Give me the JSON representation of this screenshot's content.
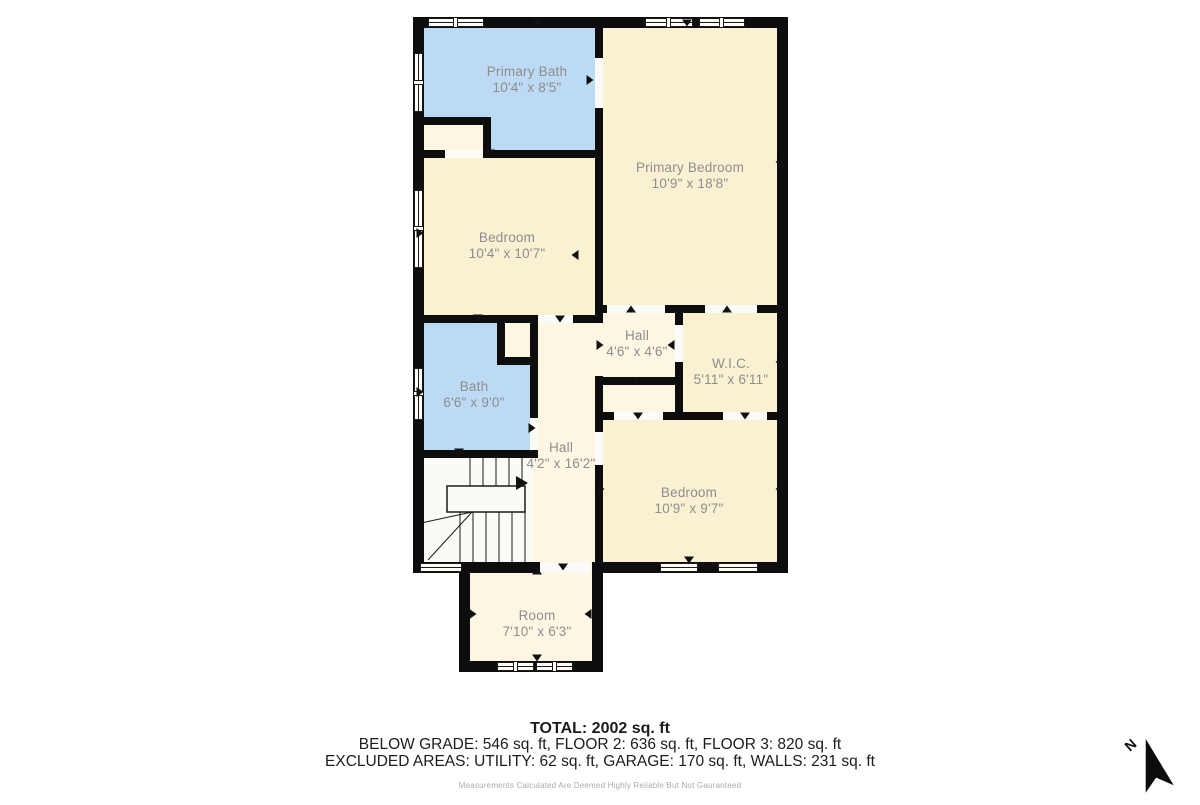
{
  "plan": {
    "rooms": [
      {
        "name": "Primary Bath",
        "dims": "10'4\" x 8'5\""
      },
      {
        "name": "Primary Bedroom",
        "dims": "10'9\" x 18'8\""
      },
      {
        "name": "Bedroom",
        "dims": "10'4\" x 10'7\""
      },
      {
        "name": "Hall",
        "dims": "4'6\" x 4'6\""
      },
      {
        "name": "W.I.C.",
        "dims": "5'11\" x 6'11\""
      },
      {
        "name": "Bath",
        "dims": "6'6\" x 9'0\""
      },
      {
        "name": "Hall",
        "dims": "4'2\" x 16'2\""
      },
      {
        "name": "Bedroom",
        "dims": "10'9\" x 9'7\""
      },
      {
        "name": "Room",
        "dims": "7'10\" x 6'3\""
      }
    ],
    "colors": {
      "wall": "#0d0d0d",
      "room_cream": "#faf0d2",
      "room_cream_light": "#fdf6e3",
      "room_blue": "#bcdaf3",
      "stairs_white": "#fbfbf6",
      "label_gray": "#8e8e8e"
    }
  },
  "footer": {
    "total": "TOTAL: 2002 sq. ft",
    "breakdown": "BELOW GRADE: 546 sq. ft, FLOOR 2: 636 sq. ft, FLOOR 3: 820 sq. ft",
    "excluded": "EXCLUDED AREAS: UTILITY: 62 sq. ft, GARAGE: 170 sq. ft, WALLS: 231 sq. ft",
    "disclaimer": "Measurements Calculated Are Deemed Highly Reliable But Not Gauranteed"
  },
  "compass": {
    "label": "N"
  }
}
